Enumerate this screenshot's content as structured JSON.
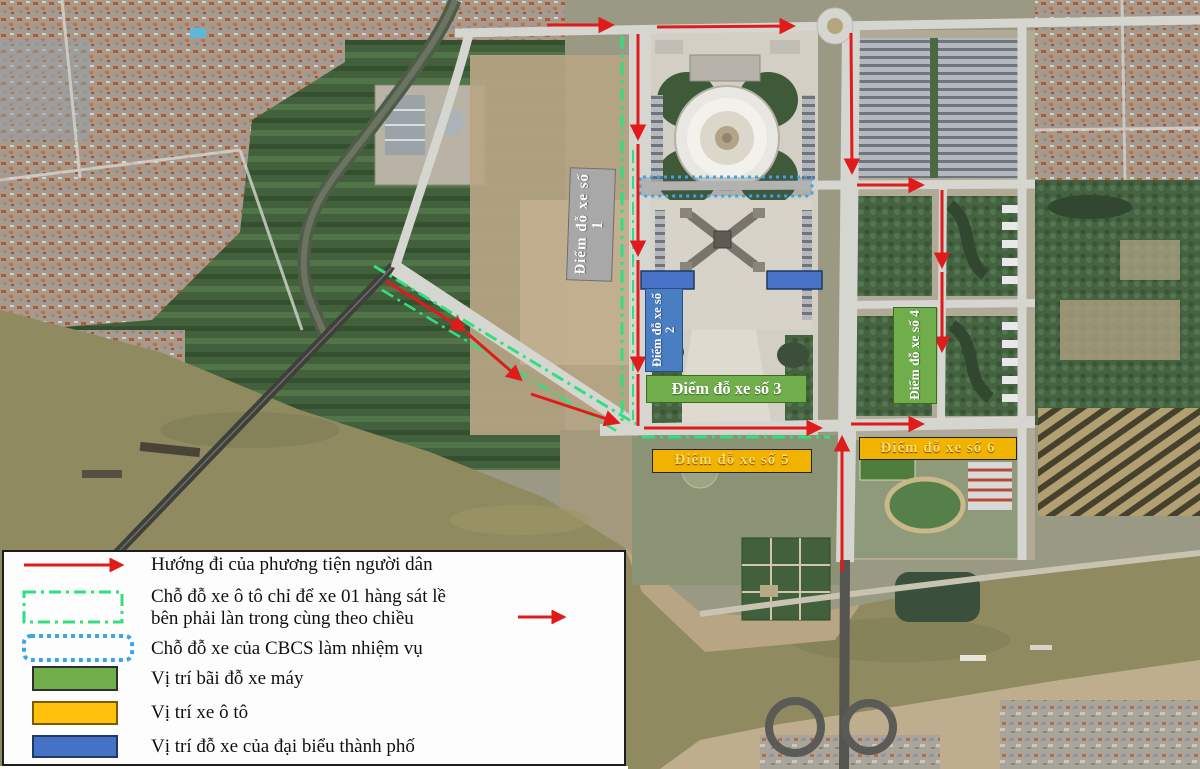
{
  "title": "Sơ đồ phân luồng giao thông và vị trí đỗ xe",
  "map": {
    "labels": [
      {
        "text": "Điểm đỗ xe số 1",
        "color_type": "gray",
        "orientation": "vertical"
      },
      {
        "text": "Điểm đỗ xe số 2",
        "color_type": "blue",
        "orientation": "vertical"
      },
      {
        "text": "Điểm đỗ xe số 3",
        "color_type": "green",
        "orientation": "horizontal"
      },
      {
        "text": "Điểm đỗ xe số 4",
        "color_type": "green",
        "orientation": "vertical"
      },
      {
        "text": "Điểm đỗ xe số 5",
        "color_type": "yellow",
        "orientation": "horizontal"
      },
      {
        "text": "Điểm đỗ xe số 6",
        "color_type": "yellow",
        "orientation": "horizontal"
      }
    ]
  },
  "legend": {
    "items": [
      {
        "icon": "red-arrow",
        "label": "Hướng đi của phương tiện người dân"
      },
      {
        "icon": "green-dashdot-rect",
        "label_line1": "Chỗ đỗ xe ô tô chỉ để xe 01 hàng sát lề",
        "label_line2": "bên phải làn trong cùng theo chiều"
      },
      {
        "icon": "blue-dotted-rect",
        "label": "Chỗ đỗ xe của CBCS làm nhiệm vụ"
      },
      {
        "icon": "green-fill",
        "label": "Vị trí bãi đỗ xe máy"
      },
      {
        "icon": "yellow-fill",
        "label": "Vị trí xe ô tô"
      },
      {
        "icon": "blue-fill",
        "label": "Vị trí đỗ xe của đại biểu thành phố"
      }
    ]
  },
  "colors": {
    "arrow_red": "#e01b1b",
    "parking_lane_green": "#30e080",
    "cbcs_blue_dotted": "#3aa5e8",
    "motorbike_green": "#6fae4b",
    "car_yellow": "#ffc10d",
    "delegate_blue": "#4472c4",
    "label_gray": "#a8a8a8"
  }
}
